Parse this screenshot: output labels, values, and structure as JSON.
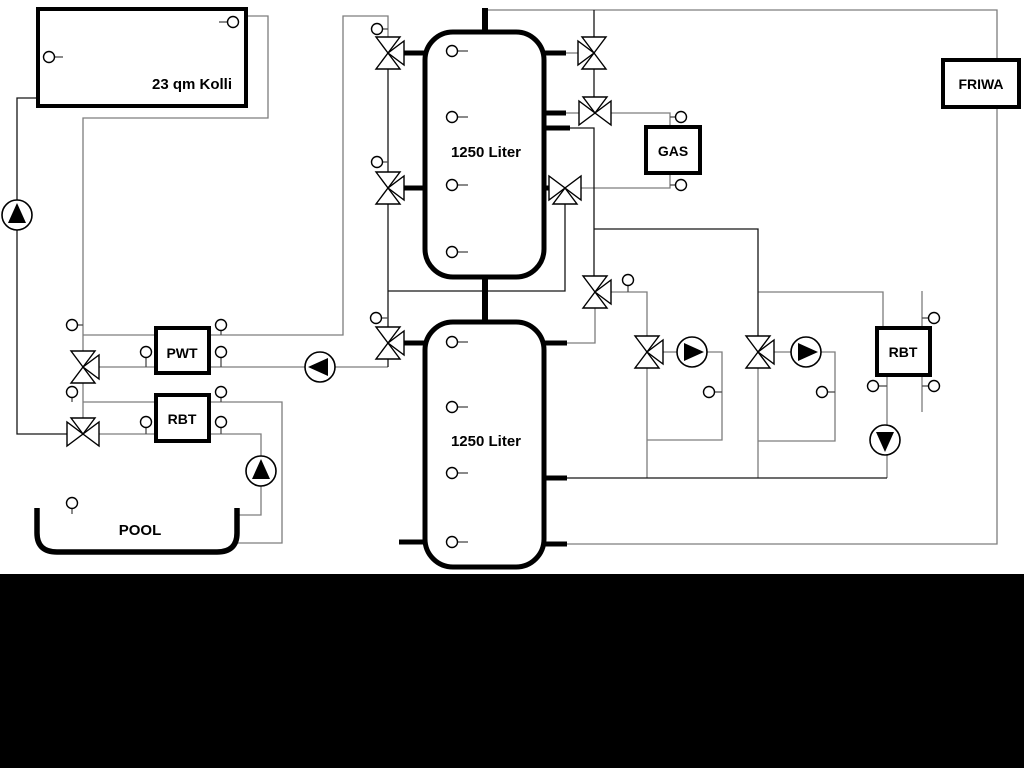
{
  "labels": {
    "collector": "23 qm Kolli",
    "tank_top": "1250 Liter",
    "tank_bottom": "1250 Liter",
    "gas": "GAS",
    "friwa": "FRIWA",
    "pwt": "PWT",
    "rbt_left": "RBT",
    "rbt_right": "RBT",
    "pool": "POOL"
  },
  "equipment": {
    "tanks": [
      {
        "name": "buffer-tank-top",
        "label": "1250 Liter"
      },
      {
        "name": "buffer-tank-bottom",
        "label": "1250 Liter"
      }
    ],
    "boxes": [
      {
        "name": "solar-collector",
        "label": "23 qm Kolli"
      },
      {
        "name": "gas-boiler",
        "label": "GAS"
      },
      {
        "name": "friwa-station",
        "label": "FRIWA"
      },
      {
        "name": "pwt-heat-exchanger",
        "label": "PWT"
      },
      {
        "name": "rbt-left",
        "label": "RBT"
      },
      {
        "name": "rbt-right",
        "label": "RBT"
      },
      {
        "name": "pool-basin",
        "label": "POOL"
      }
    ],
    "pump_count": 6,
    "three_way_valve_count": 11,
    "temp_sensor_count": 24
  },
  "colors": {
    "background": "#ffffff",
    "footer_bar": "#000000",
    "pipe_gray": "#7d7d7d",
    "pipe_dark": "#161616",
    "symbol_fill": "#ffffff"
  }
}
